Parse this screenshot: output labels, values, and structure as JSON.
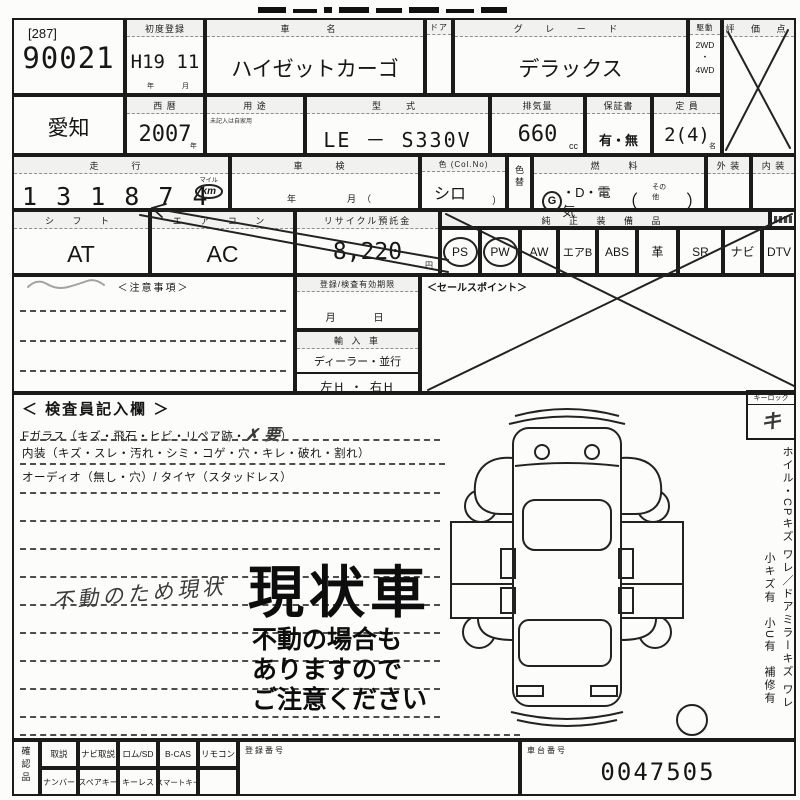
{
  "lot": {
    "bracket": "[287]",
    "number": "90021"
  },
  "row1": {
    "first_reg": {
      "label": "初度登録",
      "value": "H19 11",
      "unit_year": "年",
      "unit_month": "月"
    },
    "car_name": {
      "label": "車　名",
      "value": "ハイゼットカーゴ"
    },
    "door": {
      "label": "ドア"
    },
    "grade": {
      "label": "グ レ ー ド",
      "value": "デラックス"
    },
    "drive": {
      "label": "駆動",
      "opt1": "2WD",
      "dot": "・",
      "opt2": "4WD"
    },
    "score": {
      "label": "評 価 点"
    }
  },
  "row2": {
    "prefecture": {
      "value": "愛知"
    },
    "year": {
      "label": "西 暦",
      "value": "2007",
      "unit": "年"
    },
    "use": {
      "label": "用 途",
      "note": "未記入は自家用"
    },
    "model": {
      "label": "型　式",
      "value": "LE － S330V"
    },
    "displacement": {
      "label": "排気量",
      "value": "660",
      "unit": "cc"
    },
    "warranty": {
      "label": "保証書",
      "value": "有・無"
    },
    "capacity": {
      "label": "定 員",
      "value": "2(4)",
      "unit": "名"
    }
  },
  "row3": {
    "mileage": {
      "label": "走　行",
      "value": "131874",
      "value_grouped": "1 3 1 8 7 4",
      "mile_label": "マイル",
      "km_label": "km"
    },
    "shaken": {
      "label": "車　検",
      "bottom": "年　　　月（"
    },
    "color": {
      "label": "色 (Col.No)",
      "value": "シロ",
      "paren": "）"
    },
    "color_change": {
      "label": "色替"
    },
    "fuel": {
      "label": "燃　料",
      "g": "G",
      "rest": "・D・電気",
      "paren_open": "（",
      "other": "その他",
      "paren_close": "）"
    },
    "exterior": {
      "label": "外 装"
    },
    "interior": {
      "label": "内 装"
    }
  },
  "row4": {
    "shift": {
      "label": "シ フ ト",
      "value": "AT"
    },
    "aircon": {
      "label": "エ ア コ ン",
      "value": "AC"
    },
    "recycle": {
      "label": "リサイクル預託金",
      "value": "8,220",
      "unit": "円"
    },
    "equipment": {
      "label": "純 正 装 備 品",
      "items": [
        {
          "label": "PS"
        },
        {
          "label": "PW"
        },
        {
          "label": "AW"
        },
        {
          "label": "エアB"
        },
        {
          "label": "ABS"
        },
        {
          "label": "革"
        },
        {
          "label": "SR"
        },
        {
          "label": "ナビ"
        },
        {
          "label": "DTV"
        }
      ],
      "circled": [
        "PS",
        "PW"
      ]
    }
  },
  "mid": {
    "notes": {
      "label": "＜注意事項＞"
    },
    "expiry": {
      "label": "登録/検査有効期限",
      "value": "月　　日"
    },
    "import": {
      "label": "輸 入 車",
      "dealer": "ディーラー・並行",
      "handle": "左H ・ 右H"
    },
    "sales": {
      "label": "＜セールスポイント＞"
    }
  },
  "inspector": {
    "title": "＜ 検査員記入欄 ＞",
    "line_fglass": "Fガラス（キズ・飛石・ヒビ・リペア跡・",
    "fglass_mark": "✗ 要",
    "line_fglass_close": "）",
    "line_interior": "内装（キズ・スレ・汚れ・シミ・コゲ・穴・キレ・破れ・割れ）",
    "line_audio": "オーディオ（無し・穴）/ タイヤ（スタッドレス）",
    "handwritten": "不動のため現状",
    "stamp_big": "現状車",
    "stamp_l1": "不動の場合も",
    "stamp_l2": "ありますので",
    "stamp_l3": "ご注意ください"
  },
  "right_panel": {
    "keylock": {
      "label": "キーロック",
      "value": "キ"
    },
    "notes_col1": "ホイル・CPキズ ワレ／ドアミラーキズ ワレ",
    "notes_col2": "小キズ有　小U有　補修有"
  },
  "bottom": {
    "confirm_label": "確認品",
    "row1": [
      {
        "label": "取説"
      },
      {
        "label": "ナビ取説"
      },
      {
        "label": "ロム/SD"
      },
      {
        "label": "B-CAS"
      },
      {
        "label": "リモコン"
      }
    ],
    "row2": [
      {
        "label": "ナンバー"
      },
      {
        "label": "スペアキー"
      },
      {
        "label": "キーレス"
      },
      {
        "label": "スマートキー"
      }
    ],
    "reg_no": {
      "label": "登録番号"
    },
    "chassis": {
      "label": "車台番号",
      "value": "0047505"
    }
  }
}
